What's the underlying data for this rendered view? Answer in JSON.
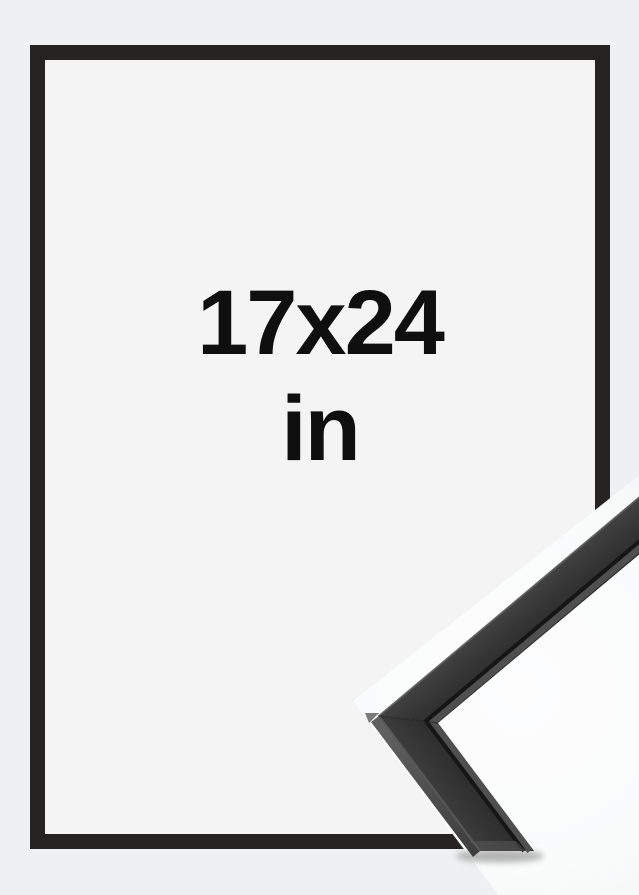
{
  "product_image": {
    "description": "black picture frame mockup with corner moulding close-up",
    "size_label": {
      "dimensions": "17x24",
      "unit": "in"
    },
    "colors": {
      "page_background": "#eff0f1",
      "frame_interior": "#f4f4f5",
      "frame_black": "#252423",
      "label_text": "#0f0f0f",
      "moulding_face_dark": "#343434",
      "moulding_inner_seam": "#161616",
      "moulding_inner_lip": "#4f4f4f",
      "photo_white": "#fcfcfd"
    },
    "icons": {
      "corner_detail": "frame-corner-moulding-photo"
    }
  }
}
